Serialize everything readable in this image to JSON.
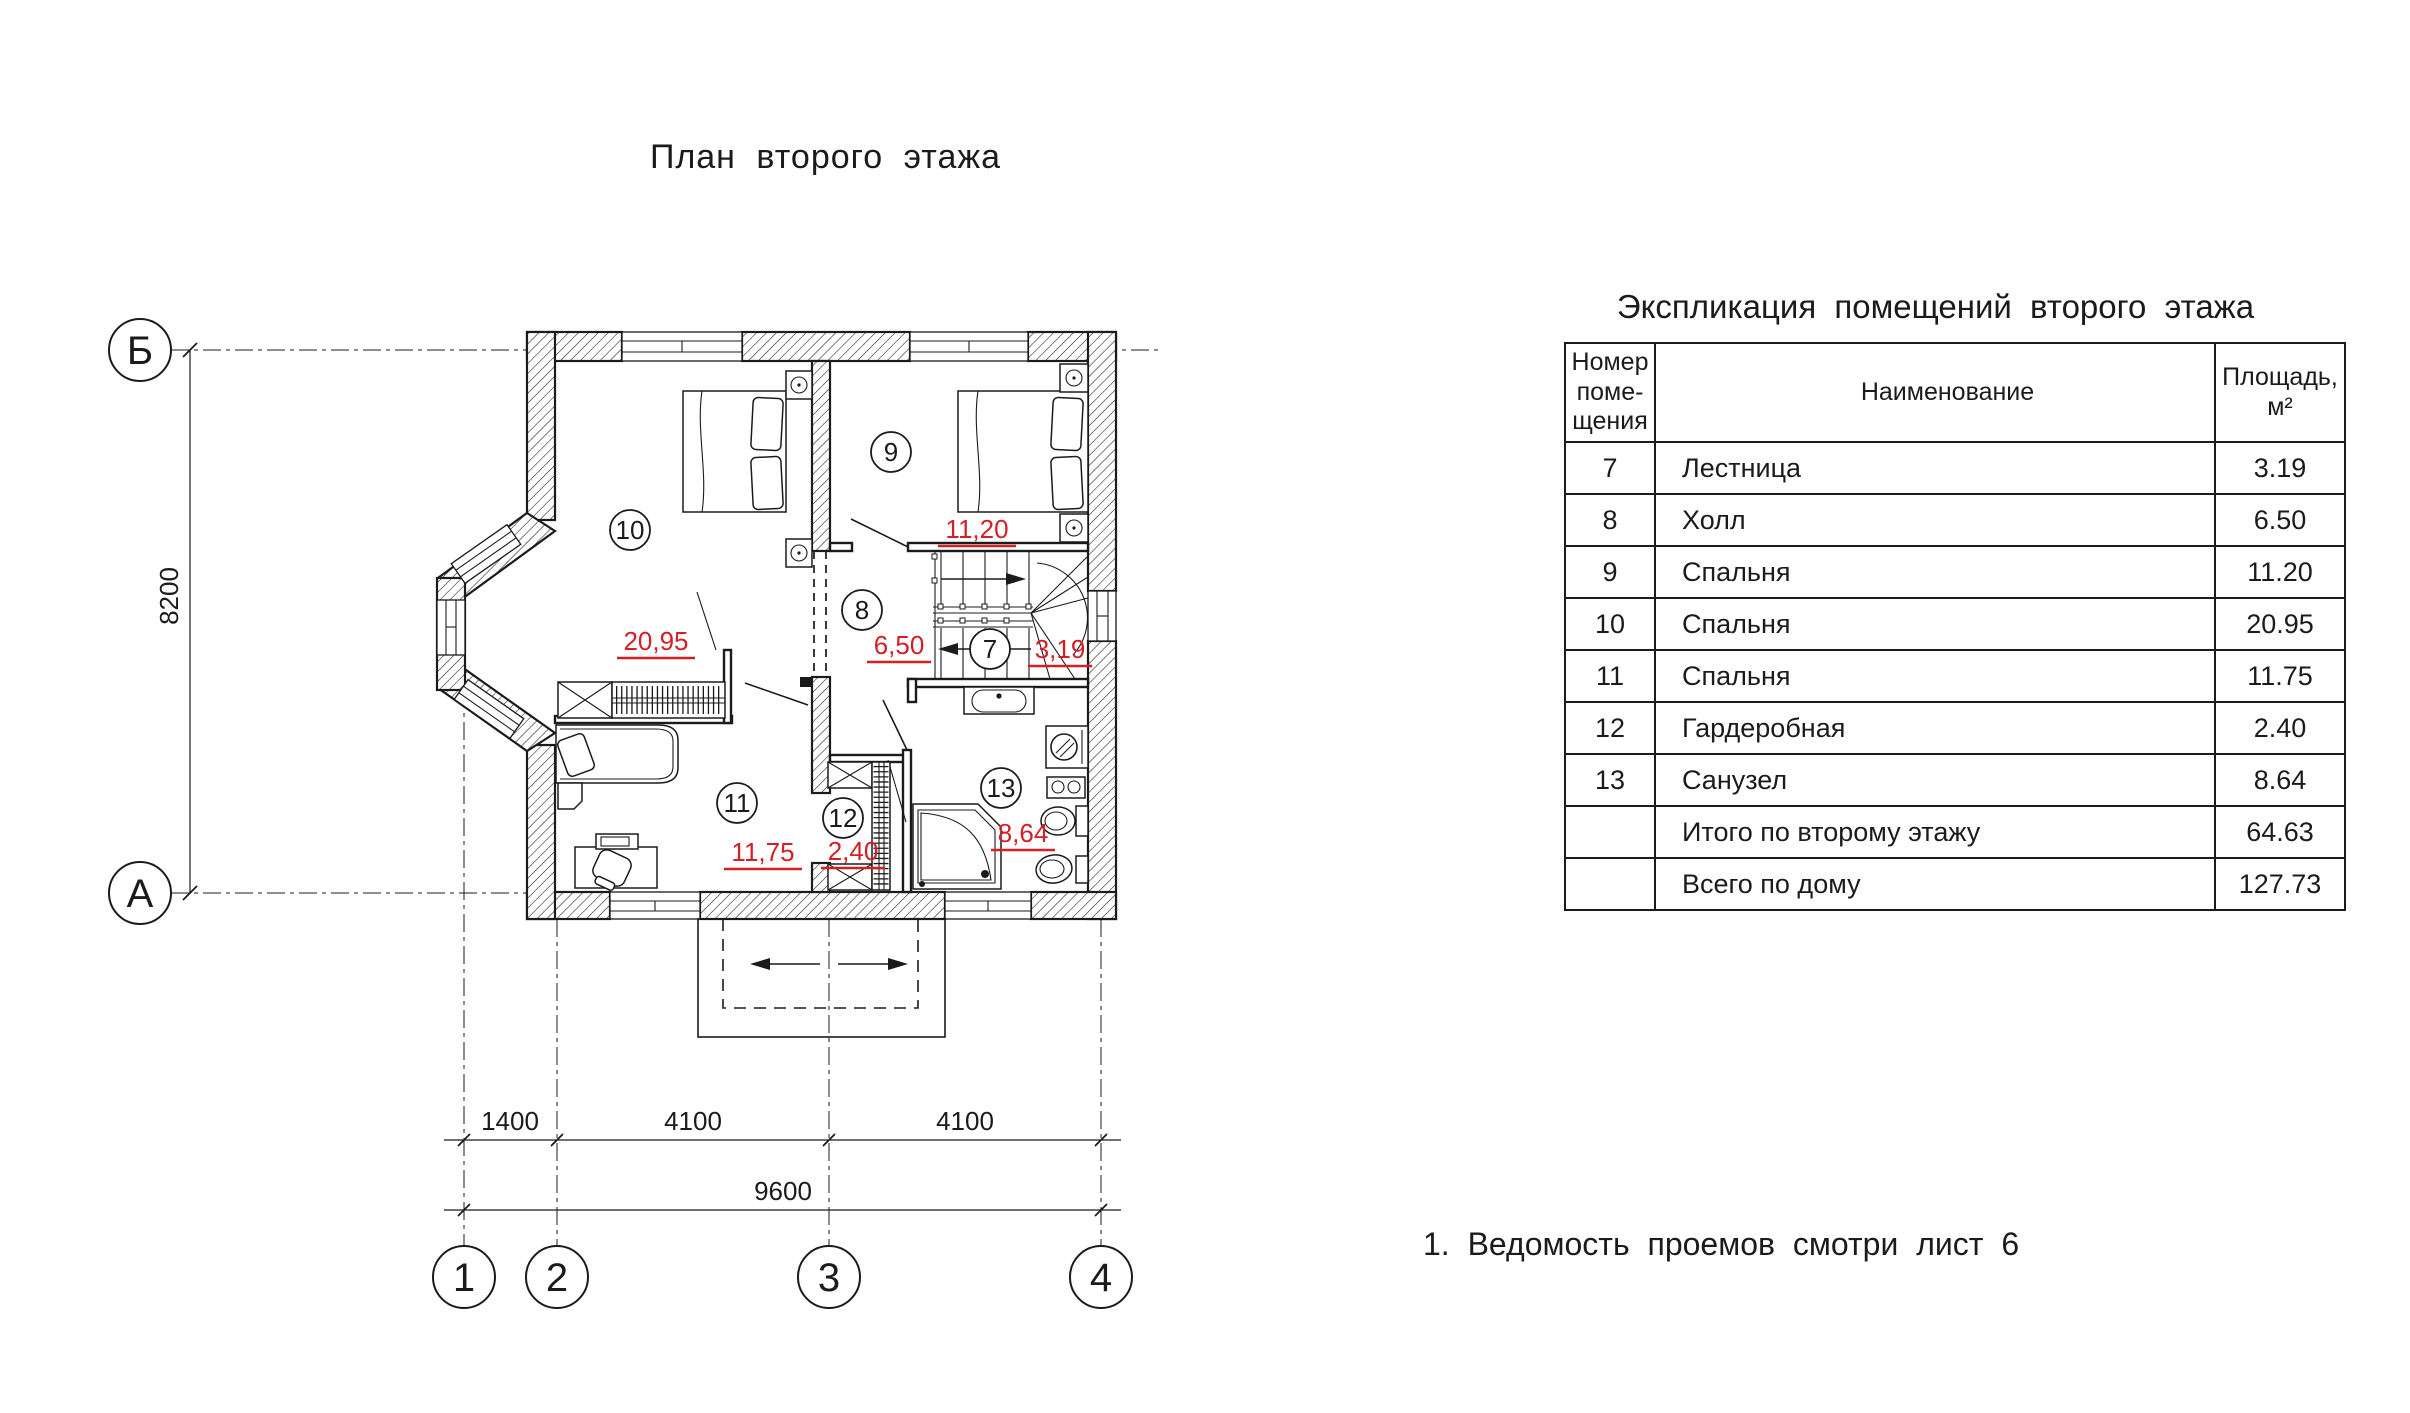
{
  "plan_title": "План второго этажа",
  "note": "1. Ведомость проемов смотри лист 6",
  "colors": {
    "dim_red": "#d31f26",
    "ink": "#1b1b1b"
  },
  "axes": {
    "row_top": "Б",
    "row_bottom": "А",
    "cols": [
      "1",
      "2",
      "3",
      "4"
    ]
  },
  "dimensions": {
    "vertical": "8200",
    "segments": [
      "1400",
      "4100",
      "4100"
    ],
    "total": "9600"
  },
  "rooms": [
    {
      "id": "7",
      "area": "3,19"
    },
    {
      "id": "8",
      "area": "6,50"
    },
    {
      "id": "9",
      "area": "11,20"
    },
    {
      "id": "10",
      "area": "20,95"
    },
    {
      "id": "11",
      "area": "11,75"
    },
    {
      "id": "12",
      "area": "2,40"
    },
    {
      "id": "13",
      "area": "8,64"
    }
  ],
  "table": {
    "title": "Экспликация помещений второго этажа",
    "headers": {
      "num": "Номер\nпоме-\nщения",
      "name": "Наименование",
      "area": "Площадь,\nм²"
    },
    "rows": [
      {
        "num": "7",
        "name": "Лестница",
        "area": "3.19"
      },
      {
        "num": "8",
        "name": "Холл",
        "area": "6.50"
      },
      {
        "num": "9",
        "name": "Спальня",
        "area": "11.20"
      },
      {
        "num": "10",
        "name": "Спальня",
        "area": "20.95"
      },
      {
        "num": "11",
        "name": "Спальня",
        "area": "11.75"
      },
      {
        "num": "12",
        "name": "Гардеробная",
        "area": "2.40"
      },
      {
        "num": "13",
        "name": "Санузел",
        "area": "8.64"
      },
      {
        "num": "",
        "name": "Итого по второму этажу",
        "area": "64.63"
      },
      {
        "num": "",
        "name": "Всего по дому",
        "area": "127.73"
      }
    ]
  }
}
